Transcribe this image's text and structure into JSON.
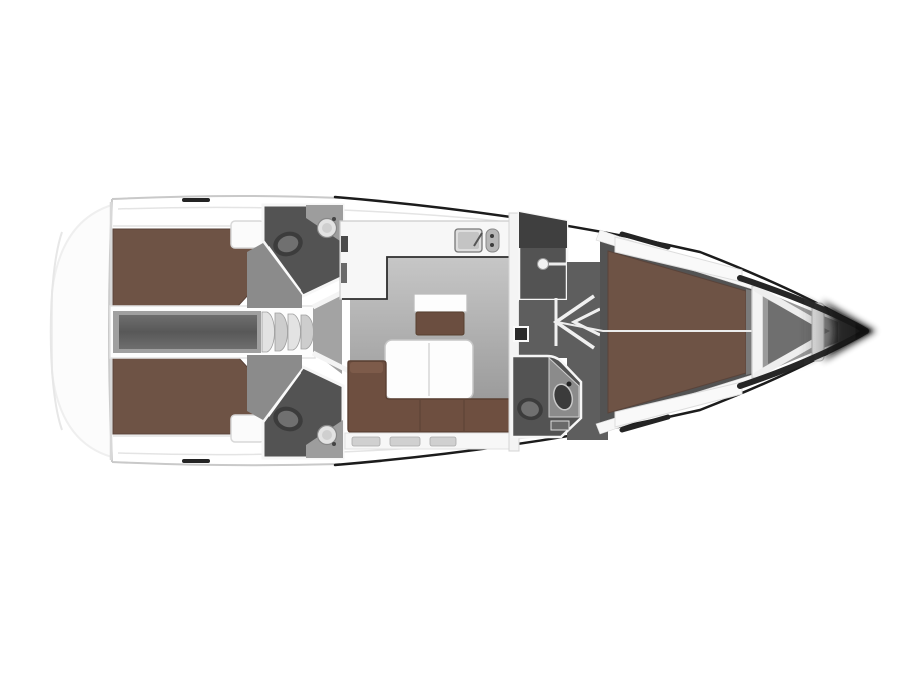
{
  "meta": {
    "title": "Sailing yacht interior layout floor plan",
    "view": "top-down",
    "bow_direction": "right",
    "text_visible": ""
  },
  "colors": {
    "background": "#ffffff",
    "hull_fill": "#ffffff",
    "hull_outline_dark": "#1c1c1c",
    "hull_outline_light": "#c9c9c9",
    "deck": "#f7f7f7",
    "wall": "#f4f4f4",
    "wall_edge": "#d9d9d9",
    "floor_light": "#c7c7c7",
    "floor_dark": "#8e8e8e",
    "lobby": "#a3a3a3",
    "room_dark": "#535353",
    "room_shadow": "#3f3f3f",
    "room_mid": "#8b8b8b",
    "berth_brown": "#6e5345",
    "berth_edge": "#59433a",
    "sofa_brown": "#6e4f40",
    "seat_brown": "#6b4e40",
    "cushion_brown": "#7d5b4a",
    "table_white": "#fdfdfd",
    "table_edge": "#c6c6c6",
    "step_light": "#e3e3e3",
    "step_mid": "#cdcdcd",
    "passage_outer": "#a0a0a0",
    "passage_inner": "#5f5f5f",
    "fixture_dark": "#3c3c3c",
    "fixture_mid": "#707070",
    "fixture_light": "#e3e3e3",
    "counter_gray": "#9d9d9d",
    "sink_metal": "#c4c4c4",
    "anchor_gray": "#9a9a9a",
    "anchor_inner": "#6f6f6f",
    "deck_slot": "#242424",
    "bow_shadow": "#111111",
    "galley_edge": "#2e2e2e"
  },
  "regions": {
    "stern_platform": "Stern swim platform",
    "aft_cabin_port": "Aft double cabin (port)",
    "aft_cabin_starboard": "Aft double cabin (starboard)",
    "engine_compartment": "Engine compartment / passage",
    "companionway": "Companionway steps",
    "aft_head_port": "Aft head with toilet and sink (port)",
    "aft_head_starboard": "Aft head with toilet and sink (starboard)",
    "salon": "Salon with L-sofa and dining table",
    "galley": "L-shaped galley with double sink",
    "chart_station": "Chart table with seat",
    "shower_room": "Separate shower compartment",
    "forward_head": "Forward head with toilet and vanity sink",
    "wardrobe": "Hanging wardrobe",
    "forward_cabin": "Forward V-berth cabin",
    "anchor_locker": "Anchor locker",
    "bow": "Bow"
  }
}
